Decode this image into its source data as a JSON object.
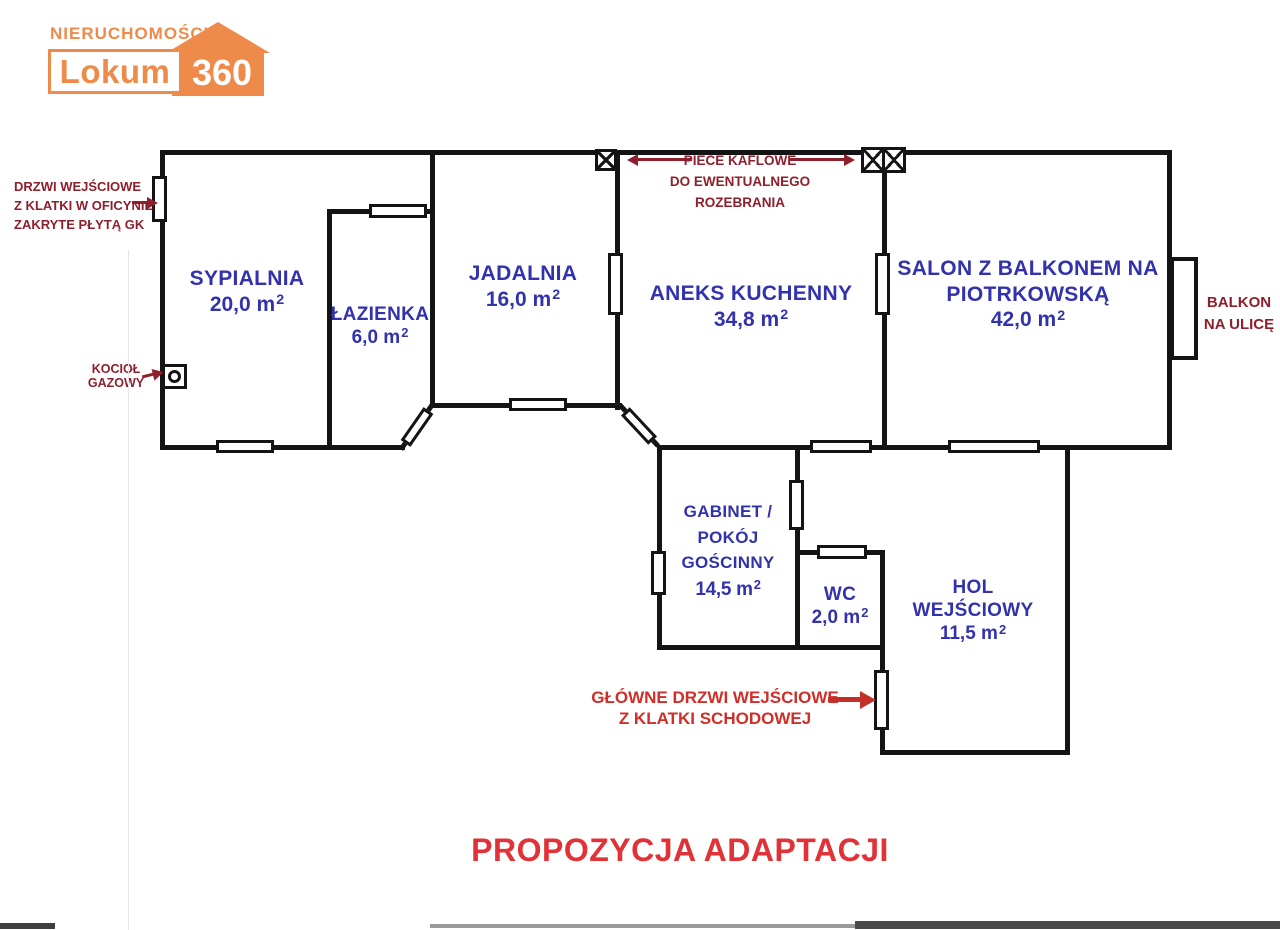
{
  "logo": {
    "tagline": "NIERUCHOMOŚCI",
    "brand": "Lokum",
    "brand_number": "360"
  },
  "plan_title": "PROPOZYCJA ADAPTACJI",
  "colors": {
    "room_label_blue": "#3232ad",
    "annotation_maroon": "#8e1f2c",
    "highlight_red": "#d02e28",
    "title_red": "#e03237",
    "logo_orange": "#ee8a4a",
    "wall_black": "#141414"
  },
  "rooms": [
    {
      "line1": "SYPIALNIA",
      "area": "20,0 m²"
    },
    {
      "line1": "ŁAZIENKA",
      "area": "6,0 m²"
    },
    {
      "line1": "JADALNIA",
      "area": "16,0 m²"
    },
    {
      "line1": "ANEKS KUCHENNY",
      "area": "34,8 m²"
    },
    {
      "line1": "SALON Z BALKONEM NA",
      "line2": "PIOTRKOWSKĄ",
      "area": "42,0 m²"
    },
    {
      "line1": "GABINET /",
      "line2": "POKÓJ GOŚCINNY",
      "area": "14,5 m²"
    },
    {
      "line1": "WC",
      "area": "2,0 m²"
    },
    {
      "line1": "HOL",
      "line2": "WEJŚCIOWY",
      "area": "11,5 m²"
    }
  ],
  "annotations": {
    "entry_door_covered": {
      "line1": "DRZWI WEJŚCIOWE",
      "line2": "Z KLATKI W OFICYNIE",
      "line3": "ZAKRYTE PŁYTĄ GK"
    },
    "tile_stoves": {
      "line1": "PIECE KAFLOWE",
      "line2": "DO EWENTUALNEGO",
      "line3": "ROZEBRANIA"
    },
    "gas_boiler": {
      "line1": "KOCIOŁ",
      "line2": "GAZOWY"
    },
    "balcony": {
      "line1": "BALKON",
      "line2": "NA ULICĘ"
    },
    "main_door": {
      "line1": "GŁÓWNE DRZWI WEJŚCIOWE",
      "line2": "Z KLATKI SCHODOWEJ"
    }
  }
}
